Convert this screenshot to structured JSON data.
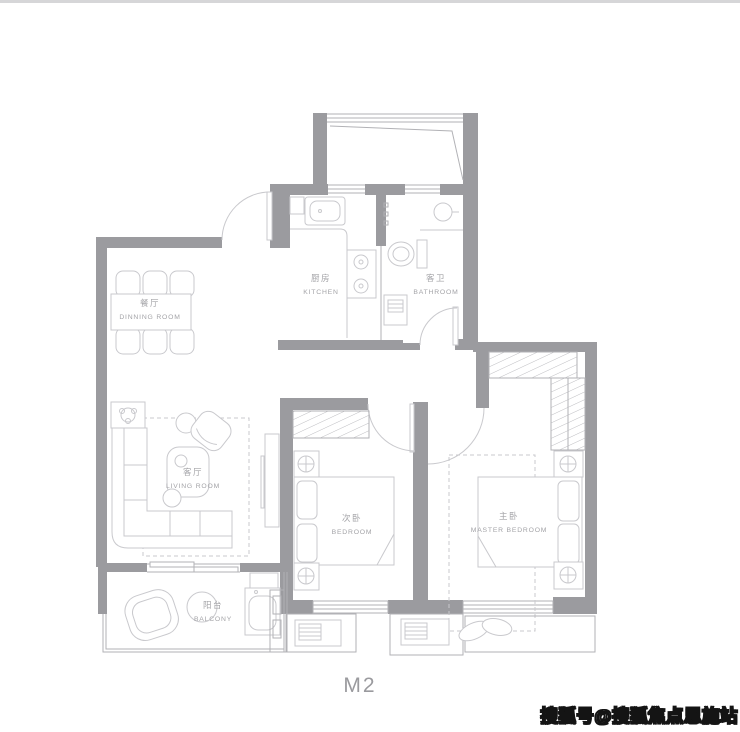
{
  "meta": {
    "caption": "M2",
    "watermark": "搜狐号@搜狐焦点恩施站"
  },
  "rooms": [
    {
      "id": "dining",
      "zh": "餐厅",
      "en": "DINNING ROOM"
    },
    {
      "id": "kitchen",
      "zh": "厨房",
      "en": "KITCHEN"
    },
    {
      "id": "bathroom",
      "zh": "客卫",
      "en": "BATHROOM"
    },
    {
      "id": "living",
      "zh": "客厅",
      "en": "LIVING ROOM"
    },
    {
      "id": "bedroom2",
      "zh": "次卧",
      "en": "BEDROOM"
    },
    {
      "id": "master",
      "zh": "主卧",
      "en": "MASTER BEDROOM"
    },
    {
      "id": "balcony",
      "zh": "阳台",
      "en": "BALCONY"
    }
  ],
  "colors": {
    "wall": "#9b9b9f",
    "line": "#c9c9cd",
    "window": "#b2b2b6",
    "label": "#a3a3a7",
    "hatch": "#bdbdc1",
    "caption": "#9a9a9e",
    "border": "#d6d6d8",
    "watermark_fill": "#ffffff",
    "watermark_outline": "#141414"
  }
}
